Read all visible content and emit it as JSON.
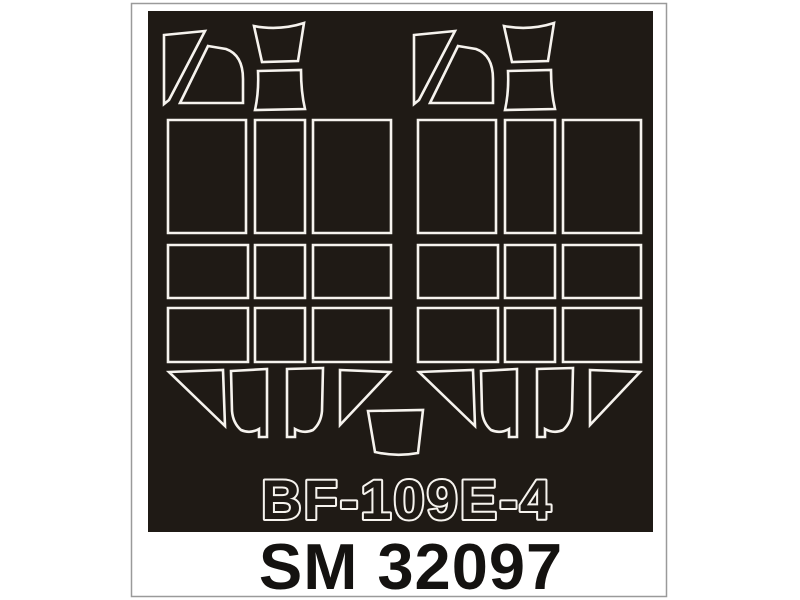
{
  "product": {
    "plane_label": "BF-109E-4",
    "product_code": "SM 32097"
  },
  "colors": {
    "page_bg": "#ffffff",
    "frame_border": "#9a9a9a",
    "sheet_black": "#1f1a15",
    "mask_line": "#f6f3ee",
    "label_fill": "#1f1a15",
    "label_outline": "#f6f3ee",
    "code_text": "#141210"
  },
  "mask_sheet": {
    "groups": [
      {
        "name": "left",
        "dx": 0
      },
      {
        "name": "right",
        "dx": 250
      }
    ],
    "shapes": [
      {
        "name": "windscreen-sliver-left",
        "d": "M 164,35 L 205,31 L 169,100 L 164,104 Z"
      },
      {
        "name": "windscreen-side-panel-left",
        "d": "M 208,46 L 226,49 Q 243,55 243,79 L 243,103 L 180,103 Z"
      },
      {
        "name": "windscreen-top-panel",
        "d": "M 254,26 Q 279,31 304,23 L 298,61 L 262,62 Z"
      },
      {
        "name": "canopy-front-top-panel",
        "d": "M 258,71 L 301,70 Q 301,92 305,109 L 255,110 Q 259,92 258,71 Z"
      },
      {
        "name": "canopy-front-side-left",
        "d": "M 168,120 L 246,120 L 246,233 L 168,233 Z"
      },
      {
        "name": "canopy-front-top-strip",
        "d": "M 255,120 L 305,120 L 305,233 L 255,233 Z"
      },
      {
        "name": "canopy-front-side-right",
        "d": "M 313,120 L 391,120 L 391,233 L 313,233 Z"
      },
      {
        "name": "canopy-mid-side-left",
        "d": "M 168,245 L 248,245 L 248,298 L 168,298 Z"
      },
      {
        "name": "canopy-mid-top",
        "d": "M 255,245 L 305,245 L 305,298 L 255,298 Z"
      },
      {
        "name": "canopy-mid-side-right",
        "d": "M 313,245 L 391,245 L 391,298 L 313,298 Z"
      },
      {
        "name": "canopy-low-side-left",
        "d": "M 168,308 L 248,308 L 248,362 L 168,362 Z"
      },
      {
        "name": "canopy-low-top",
        "d": "M 255,308 L 305,308 L 305,362 L 255,362 Z"
      },
      {
        "name": "canopy-low-side-right",
        "d": "M 313,308 L 391,308 L 391,362 L 313,362 Z"
      },
      {
        "name": "rear-glazing-wedge-left",
        "d": "M 169,372 L 223,370 L 225,426 Z"
      },
      {
        "name": "rear-glazing-panel-left",
        "d": "M 231,371 L 267,369 L 267,437 L 259,437 L 259,429 Q 250,434 241,430 Q 233,423 232,411 Z"
      },
      {
        "name": "rear-glazing-panel-right",
        "d": "M 323,368 L 287,369 L 287,437 L 295,437 L 295,429 Q 304,434 313,430 Q 321,423 322,411 Z"
      },
      {
        "name": "rear-glazing-wedge-right",
        "d": "M 340,370 L 390,372 L 340,425 Z"
      }
    ],
    "shared_shapes": [
      {
        "name": "windscreen-center-top-panel",
        "d": "M 368,411 L 423,410 L 418,453 Q 396,457 375,452 Z"
      }
    ]
  }
}
